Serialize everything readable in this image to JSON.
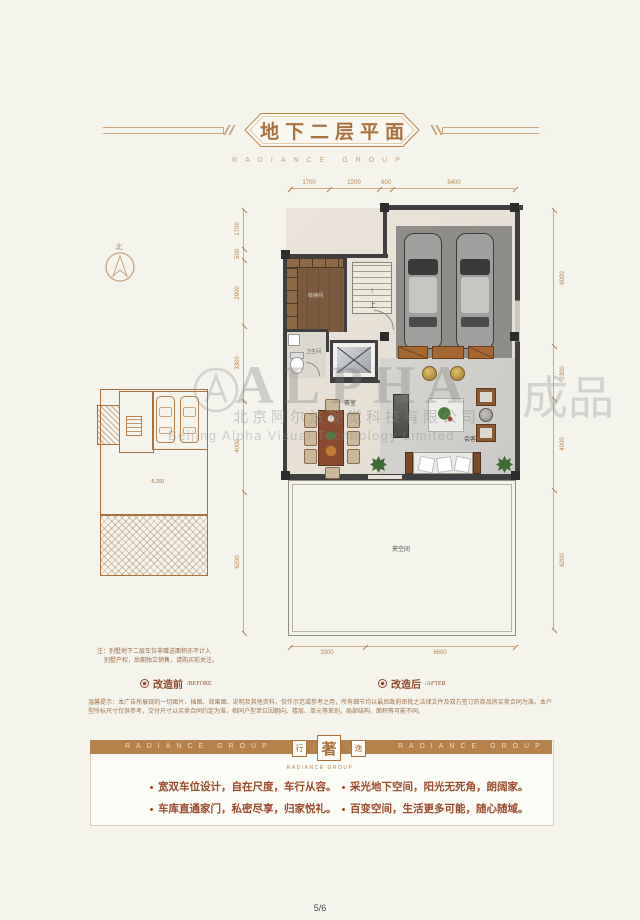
{
  "header": {
    "title": "地下二层平面",
    "brand": "RADIANCE GROUP"
  },
  "compass": {
    "north": "北"
  },
  "watermark": {
    "logo": "ALPHA",
    "extra": "成品",
    "company_cn": "北京阿尔法视觉科技有限公司",
    "company_en": "Beijing Alpha Visual Technology Limited"
  },
  "plan": {
    "dims": {
      "top": [
        "1700",
        "2200",
        "600",
        "5400"
      ],
      "left": [
        "1700",
        "500",
        "2900",
        "3300",
        "4000",
        "6200"
      ],
      "right": [
        "6000",
        "2300",
        "4000",
        "6200"
      ],
      "bottom": [
        "3300",
        "6600"
      ]
    },
    "labels": {
      "storage": "收纳间",
      "bathroom": "卫生间",
      "stairs_up": "上",
      "tea_room": "茶室",
      "reception": "会客厅",
      "void": "夹空间"
    },
    "before": {
      "elevation": "-6.200"
    }
  },
  "note": {
    "line1": "注：别墅地下二层车位非赠送面积亦不计入",
    "line2": "别墅产权，后期独立销售，请购买前关注。"
  },
  "legend": {
    "before_cn": "改造前",
    "before_en": "/BEFORE",
    "after_cn": "改造后",
    "after_en": "/AFTER"
  },
  "disclaimer": "温馨提示：本广告所展现的一切图片、插图、效果图、说明及其他资料，仅作示范或参考之用，所有细节均以最后政府审批之法律文件及双方签订的商品房买卖合同为准。本户型所标尺寸仅供参考，交付尺寸以买卖合同约定为准，相同户型单位因朝向、楼层、单元等差别，局部结构、面积等可能不同。",
  "footer": {
    "band_left": "RADIANCE GROUP",
    "band_right": "RADIANCE GROUP",
    "seal_left": "行",
    "seal_center": "著",
    "seal_right": "逸",
    "seal_sub": "RADIANCE GROUP",
    "bullets": [
      "宽双车位设计，自在尺度，车行从容。",
      "采光地下空间，阳光无死角，朗阔家。",
      "车库直通家门，私密尽享，归家悦礼。",
      "百变空间，生活更多可能，随心随域。"
    ]
  },
  "page_number": "5/6"
}
